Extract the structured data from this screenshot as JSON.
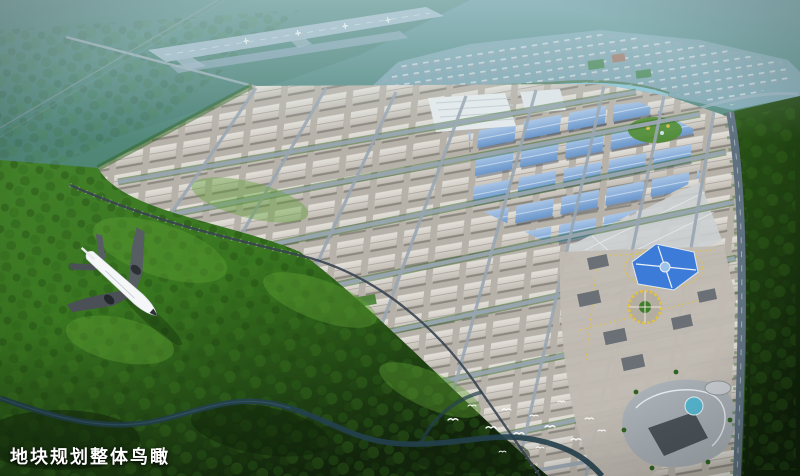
{
  "caption": {
    "text": "地块规划整体鸟瞰"
  },
  "palette": {
    "haze-top": "#6899a0",
    "haze-mid": "#4e8573",
    "runway": "#a3bac9",
    "residential-base": "#7fa5b0",
    "residential-block": "#94a3b1",
    "canal-water": "#8ec6da",
    "park-ground": "#b7b2a9",
    "road-gray": "#99a6b2",
    "roof-gray-light": "#e6e3dd",
    "roof-gray": "#c2bdb5",
    "roof-blue-light": "#a9c6e8",
    "roof-blue": "#6795cc",
    "tree-green": "#2f6420",
    "forest-light": "#5fa133",
    "forest-mid": "#38751f",
    "forest-dark": "#16300f",
    "river-water": "#24404e",
    "arterial-road": "#5f7080",
    "commercial-roof-blue": "#3d7bd8",
    "plaza-yellow": "#e2c23f",
    "airplane-white": "#f4f6f8",
    "wing-dark": "#4a5056",
    "bird-white": "#ffffff",
    "caption-color": "#ffffff"
  }
}
